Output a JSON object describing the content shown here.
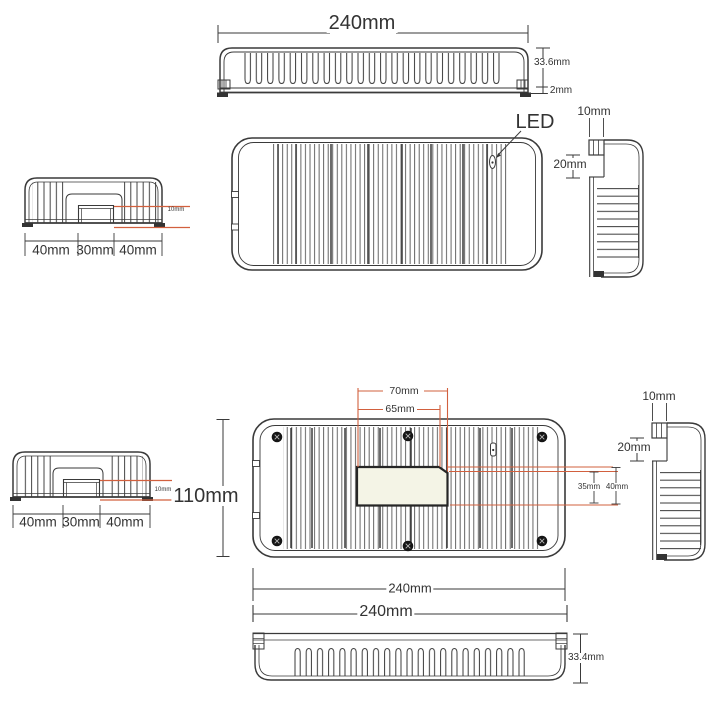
{
  "colors": {
    "line": "#3a3a3a",
    "accent_red": "#d2603e",
    "cutout_fill": "#f4f4e6"
  },
  "top_section": {
    "side_profile": {
      "width_label": "240mm",
      "height_label": "33.6mm",
      "base_label": "2mm"
    },
    "front_face": {
      "led_label": "LED"
    },
    "side_view": {
      "tab_width_label": "10mm",
      "step_height_label": "20mm"
    },
    "end_profile": {
      "left_label": "40mm",
      "center_label": "30mm",
      "right_label": "40mm",
      "fin_label": "10mm"
    }
  },
  "bottom_section": {
    "end_profile": {
      "left_label": "40mm",
      "center_label": "30mm",
      "right_label": "40mm",
      "fin_label": "10mm"
    },
    "back_face": {
      "height_label": "110mm",
      "cutout_outer_width_label": "70mm",
      "cutout_inner_width_label": "65mm",
      "cutout_inner_height_label": "35mm",
      "cutout_outer_height_label": "40mm",
      "width_label": "240mm"
    },
    "side_view": {
      "tab_width_label": "10mm",
      "step_height_label": "20mm"
    },
    "bottom_profile": {
      "width_label": "240mm",
      "height_label": "33.4mm"
    }
  }
}
